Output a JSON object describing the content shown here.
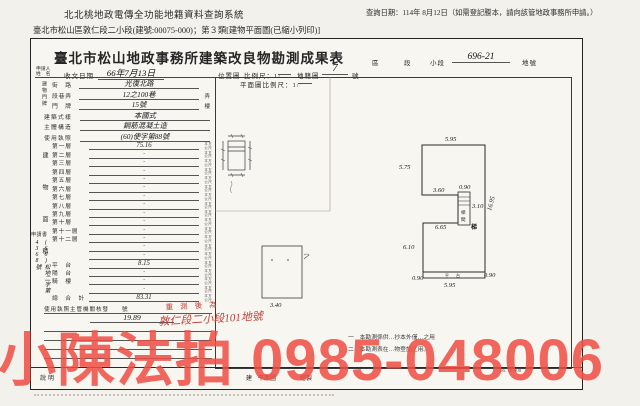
{
  "header": {
    "system_title": "北北桃地政電傳全功能地籍資料查詢系統",
    "query_date": "查詢日期：114年 8月12日（如需登記謄本，請向該管地政事務所申請。）",
    "subtitle": "臺北市松山區敦仁段二小段(建號:00075-000)；第３類[建物平面圖(已縮小列印)]"
  },
  "form": {
    "title": "臺北市松山地政事務所建築改良物勘測成果表",
    "district_label": "區",
    "section_label": "段",
    "subsection_label": "小段",
    "parcel_value": "696-21",
    "parcel_label": "地號",
    "applicant_label": "申請人",
    "applicant_name_label": "姓　名",
    "receive_date_label": "收文日期",
    "receive_date_value": "66年7月13日",
    "location_map_label": "位置圖",
    "scale_label": "比例尺：1/",
    "cadastral_map_label": "地籍圖",
    "cadastral_map_value": "7",
    "cadastral_map_unit": "號",
    "plan_scale_label": "平面圖比例尺：1/"
  },
  "fields": {
    "address_group_label": "建物門牌",
    "area_group_label": "建物面積",
    "unit_top": "平方",
    "unit_bottom": "公尺",
    "address_rows": [
      {
        "label": "街　路",
        "value": "光復北路",
        "suffix": ""
      },
      {
        "label": "段巷弄",
        "value": "12之100巷",
        "suffix": "弄"
      },
      {
        "label": "門　牌",
        "value": "15號",
        "suffix": "樓"
      }
    ],
    "info_rows": [
      {
        "label": "建築式樣",
        "value": "本國式"
      },
      {
        "label": "主體構造",
        "value": "鋼筋混凝土造"
      },
      {
        "label": "使用執照",
        "value": "(60)使字第88號"
      }
    ],
    "floors": [
      {
        "label": "第一層",
        "value": "75.16"
      },
      {
        "label": "第二層",
        "value": "·"
      },
      {
        "label": "第三層",
        "value": "·"
      },
      {
        "label": "第四層",
        "value": "·"
      },
      {
        "label": "第五層",
        "value": "·"
      },
      {
        "label": "第六層",
        "value": "·"
      },
      {
        "label": "第七層",
        "value": "·"
      },
      {
        "label": "第八層",
        "value": "·"
      },
      {
        "label": "第九層",
        "value": "·"
      },
      {
        "label": "第十層",
        "value": "·"
      },
      {
        "label": "第十一層",
        "value": "·"
      },
      {
        "label": "第十二層",
        "value": "·"
      },
      {
        "label": "",
        "value": "·"
      },
      {
        "label": "",
        "value": "·"
      },
      {
        "label": "平　台",
        "value": "8.15"
      },
      {
        "label": "陽　台",
        "value": "·"
      },
      {
        "label": "騎　樓",
        "value": "·"
      },
      {
        "label": "",
        "value": "·"
      },
      {
        "label": "總　合　計",
        "value": "83.31"
      }
    ]
  },
  "lower": {
    "license_row": "使用執照主管機關核發　　號",
    "area_after_value": "19.89",
    "application_note": "申請書",
    "application_no": "(66)松地二字第4368號",
    "stamp_line1": "重測後為",
    "stamp_line2": "敦仁段二小段101地號",
    "note1": "一　本勘測係供…抄本外僅…之用",
    "note2": "二　本勘測表在…物登記之用。",
    "footer_cell1": "說明",
    "footer_cell2": "建　平面圖",
    "footer_cell3": "繪製",
    "print_code": "66. 18,000"
  },
  "plan": {
    "dims": {
      "top": "5.95",
      "upper_left": "5.75",
      "step": "3.60",
      "stair_w": "0.90",
      "stair_h": "3.10",
      "mid": "6.65",
      "right": "16.95",
      "lower_left": "6.10",
      "bottom_left": "0.90",
      "bottom_right": "0.90",
      "bottom": "5.95",
      "mid_rect": "3.40"
    },
    "stair_char_top": "梯",
    "stair_char_bottom": "間",
    "stair_mark": "梯",
    "band_char1": "平",
    "band_char2": "台"
  },
  "watermark": {
    "text": "小陳法拍 0985-048006",
    "color": "#ef4f45"
  }
}
